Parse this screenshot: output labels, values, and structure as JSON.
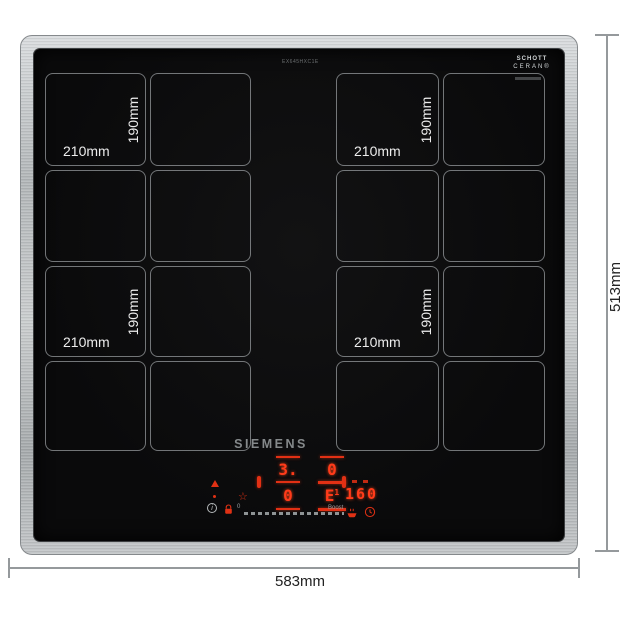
{
  "page": {
    "background": "#ffffff"
  },
  "product": {
    "brand": "SIEMENS",
    "model_text": "EX645HXC1E",
    "glass_logo": {
      "line1": "SCHOTT",
      "line2": "CERAN®"
    }
  },
  "zones": [
    {
      "name": "rear-left",
      "width_label": "210mm",
      "height_label": "190mm"
    },
    {
      "name": "rear-right",
      "width_label": "210mm",
      "height_label": "190mm"
    },
    {
      "name": "front-left",
      "width_label": "210mm",
      "height_label": "190mm"
    },
    {
      "name": "front-right",
      "width_label": "210mm",
      "height_label": "190mm"
    }
  ],
  "control_panel": {
    "brand_label": "SIEMENS",
    "displays": {
      "rear_left": "3.",
      "rear_right": "0",
      "front_left": "0",
      "front_right": "E",
      "front_right_sup": "1",
      "temperature": "160"
    },
    "slider": {
      "min_label": "0",
      "max_label": "Boost"
    },
    "icons": {
      "favorite": "☆",
      "info": "i"
    }
  },
  "dimensions": {
    "overall_width": "583mm",
    "overall_height": "513mm"
  },
  "colors": {
    "frame_silver": "#b7babc",
    "glass_black": "#0b0b0c",
    "display_red": "#ff3418",
    "zone_line_grey": "#c4c9cd",
    "dimension_grey": "#95999c"
  }
}
